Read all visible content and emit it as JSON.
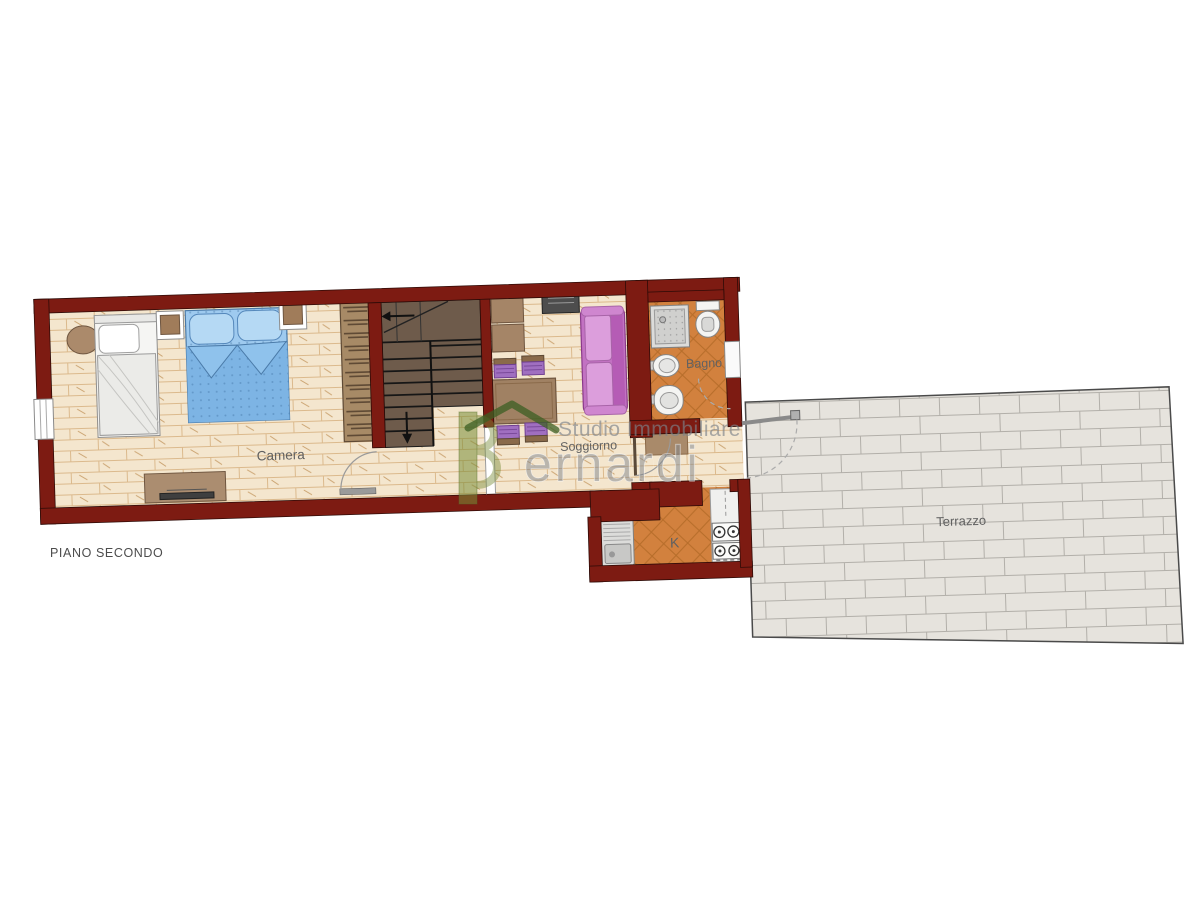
{
  "floor_label": "PIANO SECONDO",
  "rooms": {
    "camera": {
      "label": "Camera"
    },
    "soggiorno": {
      "label": "Soggiorno"
    },
    "bagno": {
      "label": "Bagno"
    },
    "kitchen": {
      "label": "K"
    },
    "terrace": {
      "label": "Terrazzo"
    }
  },
  "watermark": {
    "studio": "Studio Immobiliare",
    "brand": "ernardi"
  },
  "colors": {
    "wall": "#7d1b12",
    "wood_floor": "#f4e6ce",
    "tile_floor": "#d2813e",
    "terrace_floor": "#e6e3dd",
    "stairs": "#6e5b4b",
    "sofa": "#c272c2",
    "bed_blue": "#9ecaef",
    "furniture_brown": "#a58567",
    "logo_green": "#7e9340",
    "watermark_gray": "#82858a",
    "label_gray": "#616161"
  }
}
